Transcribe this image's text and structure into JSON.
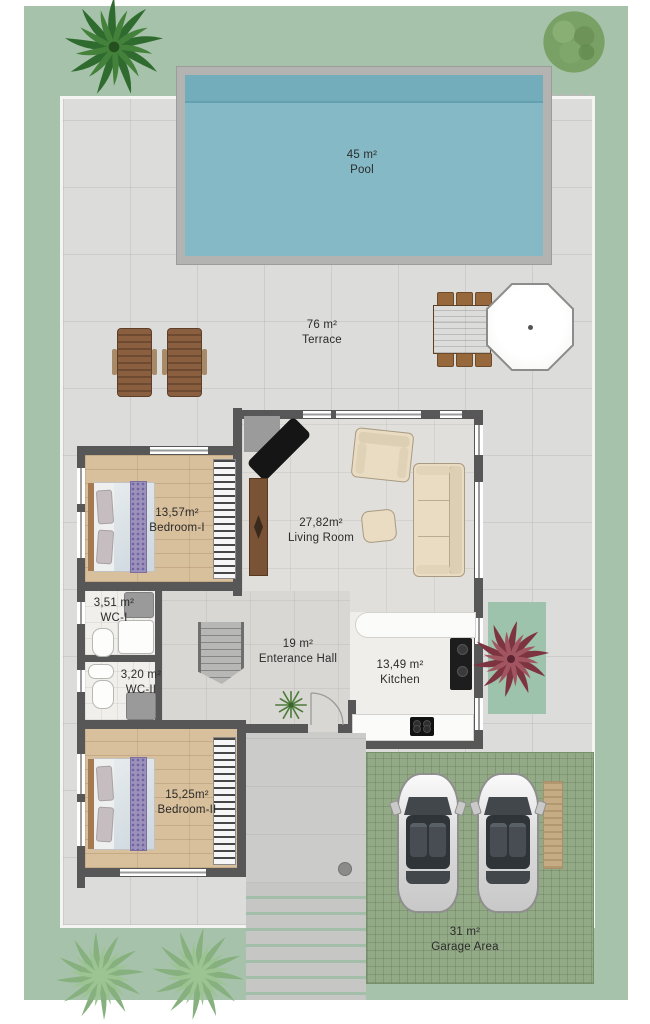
{
  "plan": {
    "type": "villa-floor-plan",
    "rooms": [
      {
        "id": "pool",
        "area": "45 m²",
        "name": "Pool"
      },
      {
        "id": "terrace",
        "area": "76 m²",
        "name": "Terrace"
      },
      {
        "id": "bedroom-1",
        "area": "13,57m²",
        "name": "Bedroom-I"
      },
      {
        "id": "living-room",
        "area": "27,82m²",
        "name": "Living Room"
      },
      {
        "id": "wc-1",
        "area": "3,51 m²",
        "name": "WC-I"
      },
      {
        "id": "entrance-hall",
        "area": "19 m²",
        "name": "Enterance Hall"
      },
      {
        "id": "wc-2",
        "area": "3,20 m²",
        "name": "WC-II"
      },
      {
        "id": "kitchen",
        "area": "13,49 m²",
        "name": "Kitchen"
      },
      {
        "id": "bedroom-2",
        "area": "15,25m²",
        "name": "Bedroom-II"
      },
      {
        "id": "garage",
        "area": "31 m²",
        "name": "Garage Area"
      }
    ],
    "colors": {
      "lawn": "#a7c2ab",
      "paving": "#dcdcda",
      "pool_water": "#84b9c5",
      "wall": "#575757",
      "wood_floor": "#d9c09c",
      "garage_lawn": "#93aa87",
      "plant_accent": "#7e3440"
    }
  }
}
